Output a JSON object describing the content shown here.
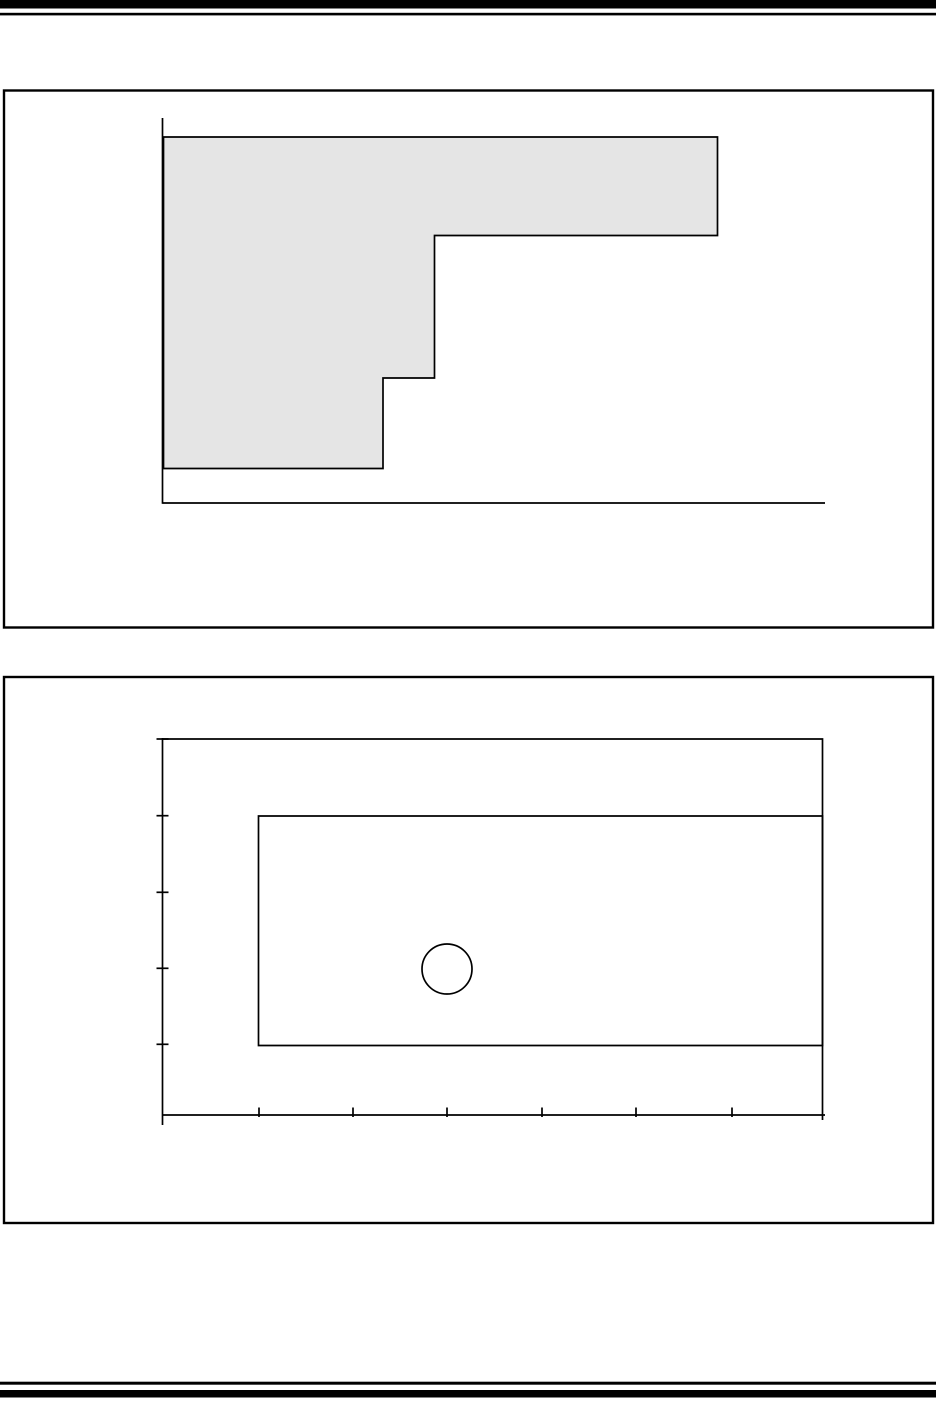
{
  "page": {
    "width": 936,
    "height": 1412,
    "background_color": "#ffffff",
    "ink_color": "#000000",
    "figure_fill_color": "#e5e5e5",
    "rules": [
      {
        "name": "header-thick-rule",
        "x": 0,
        "y": 0,
        "width": 936,
        "height": 8.5
      },
      {
        "name": "header-thin-rule",
        "x": 0,
        "y": 12.8,
        "width": 936,
        "height": 2.6
      },
      {
        "name": "footer-thin-rule",
        "x": 0,
        "y": 1381.7,
        "width": 936,
        "height": 3.0
      },
      {
        "name": "footer-thick-rule",
        "x": 0,
        "y": 1390,
        "width": 936,
        "height": 7.5
      }
    ]
  },
  "figures": [
    {
      "name": "figure-1",
      "line_width": 1.7,
      "frame": {
        "x": 4,
        "y": 90.5,
        "width": 929,
        "height": 537,
        "stroke_width": 2.4
      },
      "polygons": [
        {
          "name": "figure-1-shaded-step-region",
          "fill": "#e5e5e5",
          "stroke_width": 1.7,
          "points": [
            [
              163.5,
              137
            ],
            [
              717.5,
              137
            ],
            [
              717.5,
              235.5
            ],
            [
              434.5,
              235.5
            ],
            [
              434.5,
              378
            ],
            [
              383,
              378
            ],
            [
              383,
              468.5
            ],
            [
              163.5,
              468.5
            ]
          ]
        }
      ],
      "polylines": [],
      "lines": [
        {
          "name": "figure-1-y-axis",
          "x1": 162.5,
          "y1": 118,
          "x2": 162.5,
          "y2": 503.8
        },
        {
          "name": "figure-1-x-axis",
          "x1": 162.5,
          "y1": 503,
          "x2": 825,
          "y2": 503
        }
      ],
      "circles": []
    },
    {
      "name": "figure-2",
      "line_width": 1.7,
      "frame": {
        "x": 4,
        "y": 677,
        "width": 929,
        "height": 546,
        "stroke_width": 2.4
      },
      "polygons": [
        {
          "name": "figure-2-inner-rectangle",
          "fill": "none",
          "stroke_width": 1.7,
          "points": [
            [
              258.5,
              816
            ],
            [
              822.5,
              816
            ],
            [
              822.5,
              1045.5
            ],
            [
              258.5,
              1045.5
            ]
          ]
        }
      ],
      "polylines": [
        {
          "name": "figure-2-outer-region-border",
          "points": [
            [
              162.5,
              739
            ],
            [
              822.5,
              739
            ],
            [
              822.5,
              1120
            ]
          ]
        }
      ],
      "lines": [
        {
          "name": "figure-2-y-axis",
          "x1": 162.5,
          "y1": 738,
          "x2": 162.5,
          "y2": 1125
        },
        {
          "name": "figure-2-x-axis",
          "x1": 162.5,
          "y1": 1115,
          "x2": 825,
          "y2": 1115
        },
        {
          "name": "figure-2-y-tick-0",
          "x1": 156.5,
          "y1": 739,
          "x2": 168.5,
          "y2": 739
        },
        {
          "name": "figure-2-y-tick-1",
          "x1": 156.5,
          "y1": 815.7,
          "x2": 168.5,
          "y2": 815.7
        },
        {
          "name": "figure-2-y-tick-2",
          "x1": 156.5,
          "y1": 892.3,
          "x2": 168.5,
          "y2": 892.3
        },
        {
          "name": "figure-2-y-tick-3",
          "x1": 156.5,
          "y1": 968.3,
          "x2": 168.5,
          "y2": 968.3
        },
        {
          "name": "figure-2-y-tick-4",
          "x1": 156.5,
          "y1": 1044.3,
          "x2": 168.5,
          "y2": 1044.3
        },
        {
          "name": "figure-2-x-tick-0",
          "x1": 259,
          "y1": 1107.5,
          "x2": 259,
          "y2": 1117
        },
        {
          "name": "figure-2-x-tick-1",
          "x1": 353,
          "y1": 1107.5,
          "x2": 353,
          "y2": 1117
        },
        {
          "name": "figure-2-x-tick-2",
          "x1": 447,
          "y1": 1107.5,
          "x2": 447,
          "y2": 1117
        },
        {
          "name": "figure-2-x-tick-3",
          "x1": 542,
          "y1": 1107.5,
          "x2": 542,
          "y2": 1117
        },
        {
          "name": "figure-2-x-tick-4",
          "x1": 636,
          "y1": 1107.5,
          "x2": 636,
          "y2": 1117
        },
        {
          "name": "figure-2-x-tick-5",
          "x1": 732,
          "y1": 1107.5,
          "x2": 732,
          "y2": 1117
        }
      ],
      "circles": [
        {
          "name": "figure-2-circle",
          "cx": 447,
          "cy": 969,
          "r": 25
        }
      ]
    }
  ],
  "chart_data": [
    {
      "type": "area",
      "title": "",
      "xlabel": "",
      "ylabel": "",
      "legend": "none",
      "grid": "off",
      "description": "Unlabeled descending step region with 3 steps, filled light gray, on plain L-shaped axes with no tick marks or labels",
      "axes_px": {
        "origin": [
          162.5,
          503
        ],
        "x_end": 825,
        "y_top": 118
      },
      "step_outline_px": [
        [
          163.5,
          137
        ],
        [
          717.5,
          137
        ],
        [
          717.5,
          235.5
        ],
        [
          434.5,
          235.5
        ],
        [
          434.5,
          378
        ],
        [
          383,
          378
        ],
        [
          383,
          468.5
        ],
        [
          163.5,
          468.5
        ]
      ]
    },
    {
      "type": "other",
      "title": "",
      "xlabel": "",
      "ylabel": "",
      "legend": "none",
      "grid": "off",
      "description": "Unlabeled axes frame: y-axis with 5 ticks, x-axis with 6 interior ticks, an outer rectangle (top and right edges drawn), an inner rectangle, and one small unfilled circle",
      "axes_px": {
        "origin": [
          162.5,
          1115
        ],
        "x_end": 825,
        "y_top": 738
      },
      "y_tick_positions_px": [
        739,
        815.7,
        892.3,
        968.3,
        1044.3
      ],
      "x_tick_positions_px": [
        259,
        353,
        447,
        542,
        636,
        732
      ],
      "outer_rect_px": [
        162.5,
        739,
        822.5,
        1115
      ],
      "inner_rect_px": [
        258.5,
        816,
        822.5,
        1045.5
      ],
      "circle_px": {
        "cx": 447,
        "cy": 969,
        "r": 25
      }
    }
  ]
}
